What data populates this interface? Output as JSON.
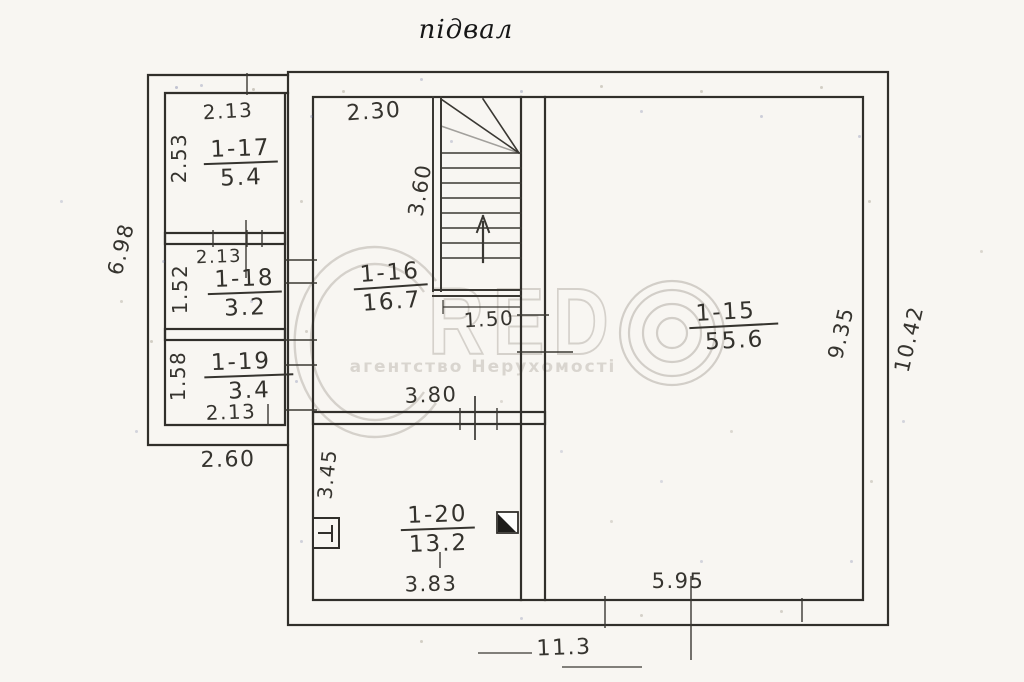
{
  "title": "підвал",
  "watermark": {
    "brand_mid": "RED",
    "tagline": "агентство Нерухомості"
  },
  "rooms": {
    "r1_17": {
      "number": "1-17",
      "area": "5.4"
    },
    "r1_18": {
      "number": "1-18",
      "area": "3.2"
    },
    "r1_19": {
      "number": "1-19",
      "area": "3.4"
    },
    "r1_16": {
      "number": "1-16",
      "area": "16.7"
    },
    "r1_15": {
      "number": "1-15",
      "area": "55.6"
    },
    "r1_20": {
      "number": "1-20",
      "area": "13.2"
    }
  },
  "dims": {
    "w117_top": "2.13",
    "h117_left": "2.53",
    "w118_top": "2.13",
    "h118_left": "1.52",
    "h119_left": "1.58",
    "w119_bot": "2.13",
    "annex_height": "6.98",
    "annex_bottom": "2.60",
    "w116_top": "2.30",
    "stair_length": "3.60",
    "stair_width": "1.50",
    "w120_top": "3.80",
    "h120_left": "3.45",
    "w120_bot": "3.83",
    "h115_right": "9.35",
    "main_height": "10.42",
    "w115_bot": "5.95",
    "main_bottom": "11.3"
  },
  "colors": {
    "ink": "#312f2b",
    "paper": "#f8f6f2",
    "watermark": "#d5d1cb"
  }
}
